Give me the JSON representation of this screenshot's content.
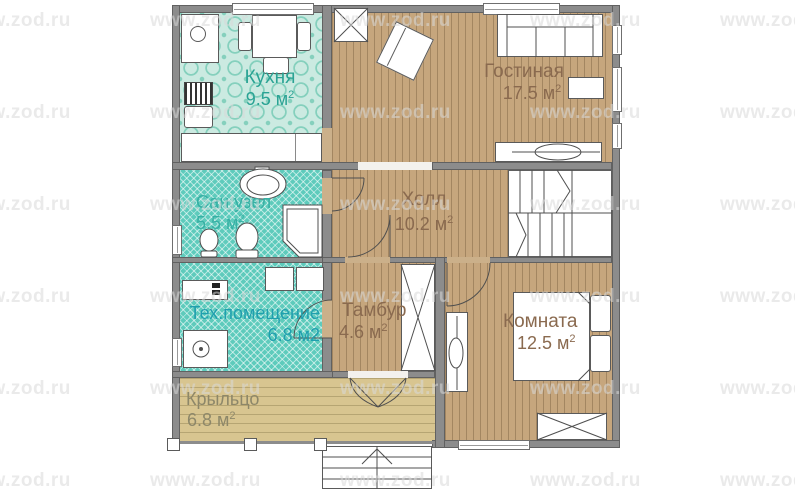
{
  "watermark": {
    "text": "www.zod.ru"
  },
  "rooms": {
    "kitchen": {
      "name": "Кухня",
      "area": "9.5 м",
      "sup": "2"
    },
    "living": {
      "name": "Гостиная",
      "area": "17.5 м",
      "sup": "2"
    },
    "bathroom": {
      "name": "Сан.узел",
      "area": "5.5 м",
      "sup": "2"
    },
    "hall": {
      "name": "Холл",
      "area": "10.2 м",
      "sup": "2"
    },
    "tech": {
      "name": "Тех.помещение",
      "area": "6.8 м2",
      "sup": ""
    },
    "tambour": {
      "name": "Тамбур",
      "area": "4.6 м",
      "sup": "2"
    },
    "bedroom": {
      "name": "Комната",
      "area": "12.5 м",
      "sup": "2"
    },
    "porch": {
      "name": "Крыльцо",
      "area": "6.8 м",
      "sup": "2"
    }
  },
  "colors": {
    "wall": "#8c8c8c",
    "wood_floor": "#c6a67d",
    "porch_floor": "#d8c590",
    "teal_floor": "#5ecbbc",
    "kitchen_floor": "#cbeae1",
    "label_teal": "#2aa394",
    "label_bath": "#36b0a4",
    "label_tech": "#1f9fae",
    "label_brown": "#8a6a4f",
    "label_porch": "#8d8769"
  }
}
